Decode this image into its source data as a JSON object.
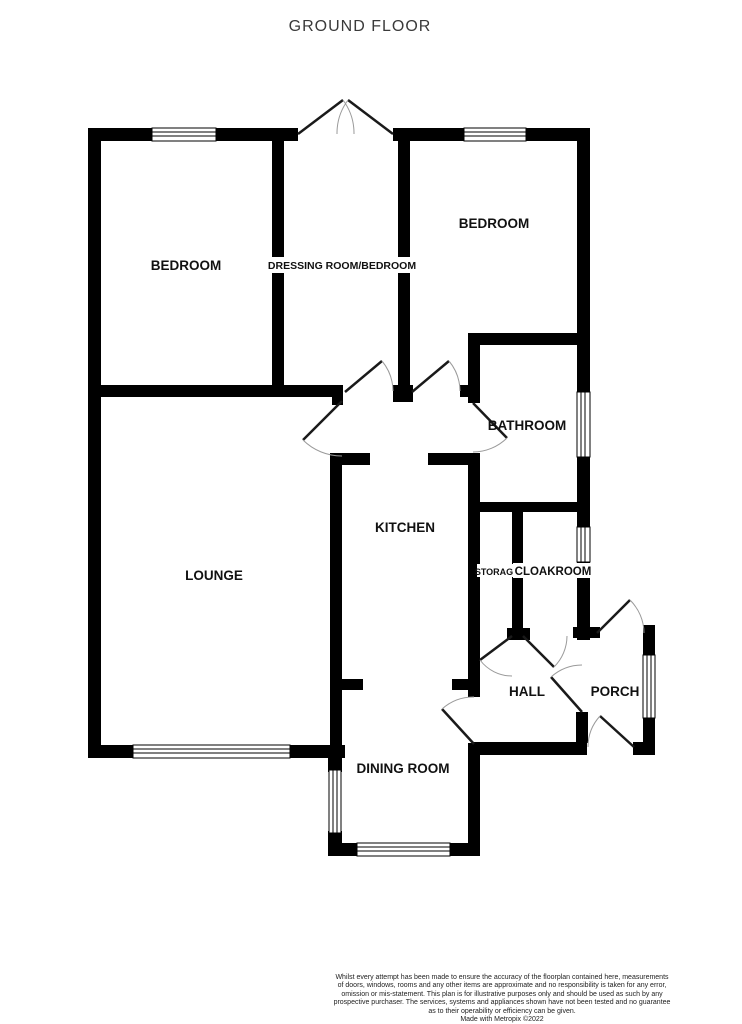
{
  "title": "GROUND FLOOR",
  "colors": {
    "wall": "#000000",
    "door_leaf": "#1a1a1a",
    "door_arc": "#9a9a9a",
    "text": "#111111"
  },
  "rooms": {
    "bedroom1": {
      "label": "BEDROOM"
    },
    "dressing": {
      "label": "DRESSING ROOM/BEDROOM"
    },
    "bedroom2": {
      "label": "BEDROOM"
    },
    "bathroom": {
      "label": "BATHROOM"
    },
    "kitchen": {
      "label": "KITCHEN"
    },
    "lounge": {
      "label": "LOUNGE"
    },
    "storage": {
      "label": "STORAGE"
    },
    "cloakroom": {
      "label": "CLOAKROOM"
    },
    "hall": {
      "label": "HALL"
    },
    "porch": {
      "label": "PORCH"
    },
    "dining": {
      "label": "DINING ROOM"
    }
  },
  "footer": {
    "lines": [
      "Whilst every attempt has been made to ensure the accuracy of the floorplan contained here, measurements",
      "of doors, windows, rooms and any other items are approximate and no responsibility is taken for any error,",
      "omission or mis-statement. This plan is for illustrative purposes only and should be used as such by any",
      "prospective purchaser. The services, systems and appliances shown have not been tested and no guarantee",
      "as to their operability or efficiency can be given.",
      "Made with Metropix ©2022"
    ]
  }
}
